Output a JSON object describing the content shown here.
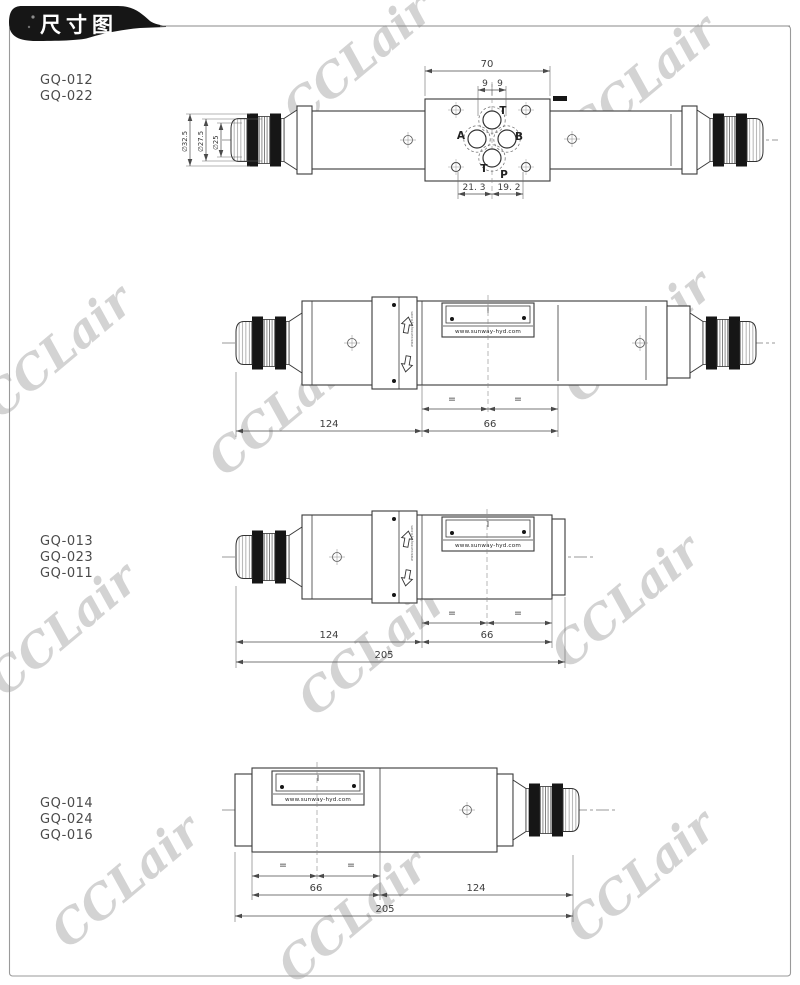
{
  "page": {
    "banner_title": "尺寸图",
    "watermark": "CCLair",
    "colors": {
      "paper": "#ffffff",
      "banner_bg": "#161616",
      "banner_text": "#ffffff",
      "line": "#3a3a3a",
      "dim_text": "#3d3d3d",
      "watermark": "#c7c7c7",
      "border": "#999999"
    }
  },
  "drawing1": {
    "models": [
      "GQ-012",
      "GQ-022"
    ],
    "ports": {
      "top": "T",
      "left": "A",
      "right": "B",
      "bottom_left": "T",
      "bottom": "P"
    },
    "dims": {
      "block_width": "70",
      "port_offset_left": "9",
      "port_offset_right": "9",
      "bottom_left": "21. 3",
      "bottom_right": "19. 2",
      "dia_outer": "∅32.5",
      "dia_mid": "∅27.5",
      "dia_inner": "∅25"
    }
  },
  "drawing2": {
    "dims": {
      "left": "124",
      "right": "66"
    },
    "equal_left": "=",
    "equal_right": "=",
    "nameplate_url": "www.sunway-hyd.com"
  },
  "drawing3": {
    "models": [
      "GQ-013",
      "GQ-023",
      "GQ-011"
    ],
    "dims": {
      "left": "124",
      "right": "66",
      "overall": "205"
    },
    "equal_left": "=",
    "equal_right": "=",
    "nameplate_url": "www.sunway-hyd.com"
  },
  "drawing4": {
    "models": [
      "GQ-014",
      "GQ-024",
      "GQ-016"
    ],
    "dims": {
      "left": "66",
      "right": "124",
      "overall": "205"
    },
    "equal_left": "=",
    "equal_right": "=",
    "nameplate_url": "www.sunway-hyd.com"
  }
}
